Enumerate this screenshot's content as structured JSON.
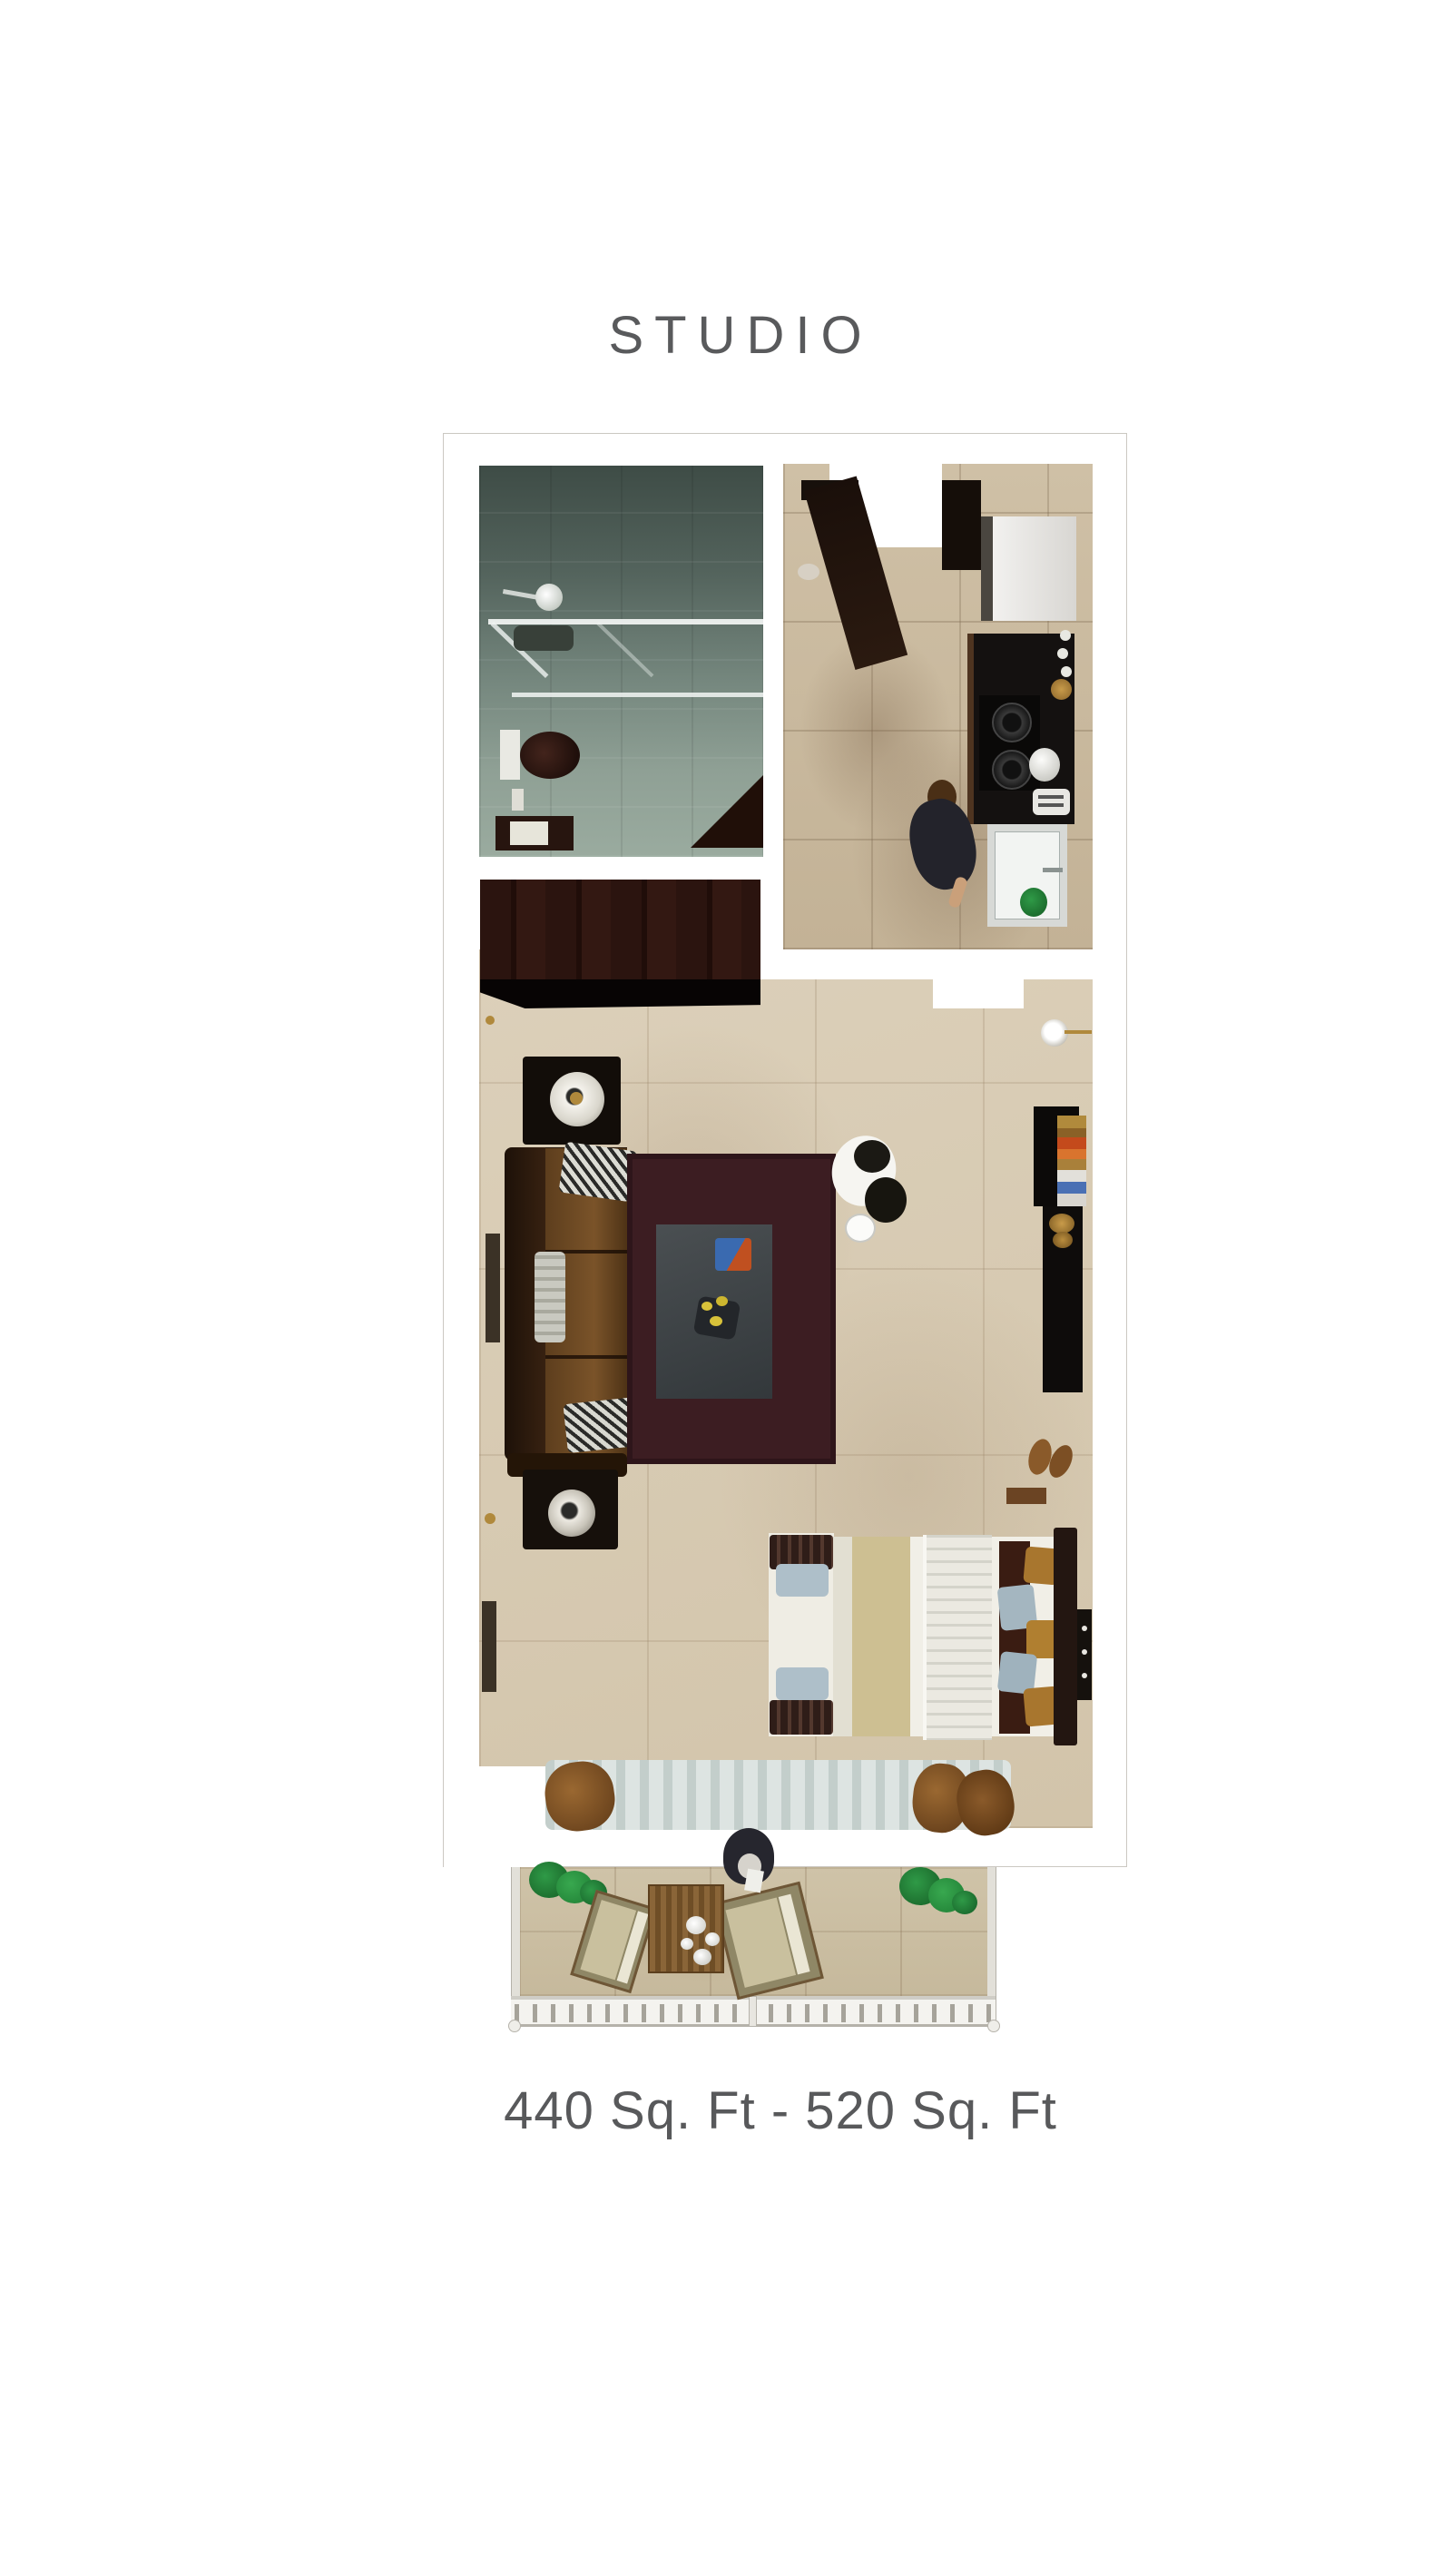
{
  "title": "STUDIO",
  "area_label": "440 Sq. Ft - 520 Sq. Ft",
  "text_color": "#58595b",
  "plan": {
    "rooms": [
      "bathroom",
      "kitchen",
      "living-area",
      "sleeping-area",
      "balcony"
    ],
    "colors": {
      "living_floor": "#d6c9b2",
      "kitchen_floor": "#c9b79c",
      "bathroom_tile": "#75877f",
      "wardrobe_wood": "#2b1410",
      "sofa_leather": "#6e4b24",
      "rug": "#3c1d22",
      "coffee_table": "#43484b",
      "bed_runner": "#cdbf92",
      "curtain": "#cfd8d6",
      "balcony_floor": "#cbbfa4",
      "plant": "#2f9a47",
      "outdoor_wood": "#8a6538"
    }
  }
}
